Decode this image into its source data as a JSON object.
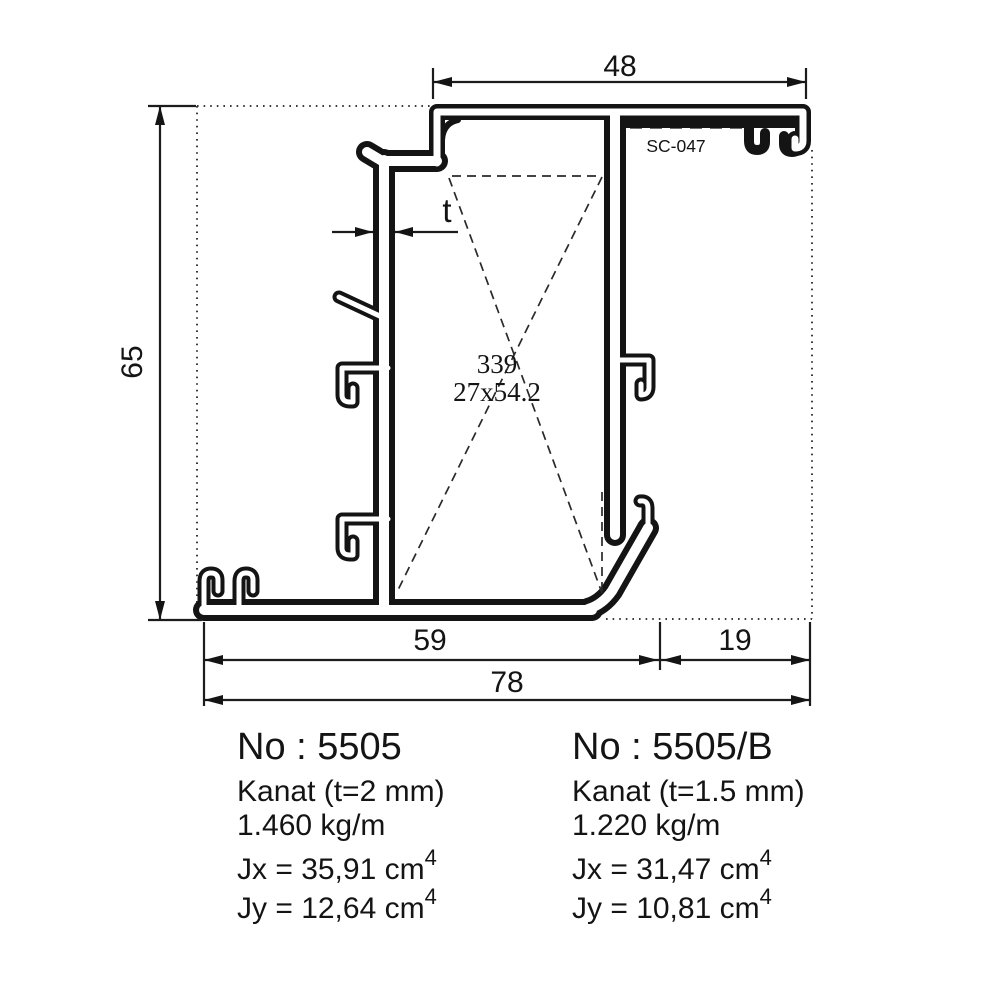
{
  "dimensions": {
    "top_width": "48",
    "left_height": "65",
    "bottom_inner": "59",
    "bottom_right": "19",
    "bottom_total": "78",
    "thickness": "t"
  },
  "annotations": {
    "accessory_code": "SC-047",
    "chamber_area": "339",
    "chamber_size": "27x54.2"
  },
  "specs": {
    "left": {
      "no": "No : 5505",
      "type": "Kanat (t=2 mm)",
      "weight": "1.460 kg/m",
      "jx": "Jx = 35,91 cm",
      "jx_exp": "4",
      "jy": "Jy = 12,64 cm",
      "jy_exp": "4"
    },
    "right": {
      "no": "No : 5505/B",
      "type": "Kanat (t=1.5 mm)",
      "weight": "1.220 kg/m",
      "jx": "Jx = 31,47 cm",
      "jx_exp": "4",
      "jy": "Jy = 10,81 cm",
      "jy_exp": "4"
    }
  },
  "colors": {
    "ink": "#141414",
    "background": "#ffffff"
  }
}
